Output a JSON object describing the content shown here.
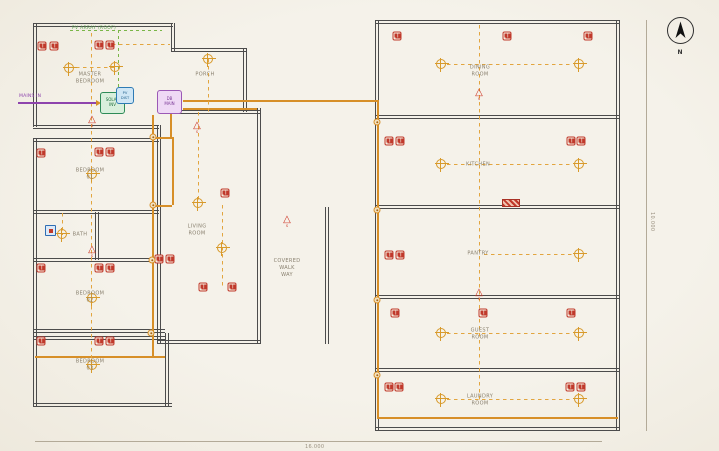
{
  "drawing": {
    "north_label": "N",
    "dimensions": {
      "bottom": "16.000",
      "right": "10.000"
    },
    "annotations": {
      "pv_array": "PV ARRAY (ROOF)",
      "mains": "MAINS IN",
      "switch_label": "S"
    },
    "equipment": {
      "solar_inverter": {
        "line1": "SOLAR",
        "line2": "INV"
      },
      "pv_dist": {
        "line1": "PV",
        "line2": "DIST"
      },
      "db_main": {
        "line1": "DB",
        "line2": "MAIN"
      }
    },
    "icons": {
      "switch_triangle": "△",
      "north_arrow": "north-arrow",
      "ceiling_light": "circle-cross-light",
      "power_outlet": "duplex-outlet"
    },
    "colors": {
      "background": "#f5f2ea",
      "wall": "#4c4c4c",
      "outlet_red": "#c0392b",
      "light_orange": "#d89a2b",
      "circuit_dashed": "#e2a53f",
      "feeder_solid": "#d78f28",
      "pv_green": "#7ab648",
      "mains_purple": "#8e44ad",
      "solar_box": "#2e8b57",
      "pv_box": "#2e7bb5",
      "db_box": "#9b59b6",
      "label_gray": "#89806f"
    },
    "rooms": [
      {
        "label": "MASTER BEDROOM",
        "x": 90,
        "y": 78
      },
      {
        "label": "PORCH",
        "x": 205,
        "y": 75
      },
      {
        "label": "BEDROOM 01",
        "x": 90,
        "y": 174
      },
      {
        "label": "BATH",
        "x": 80,
        "y": 235
      },
      {
        "label": "BEDROOM 02",
        "x": 90,
        "y": 297
      },
      {
        "label": "BEDROOM 03",
        "x": 90,
        "y": 365
      },
      {
        "label": "LIVING ROOM",
        "x": 197,
        "y": 230
      },
      {
        "label": "COVERED\nWALK WAY",
        "x": 287,
        "y": 268
      },
      {
        "label": "DINING ROOM",
        "x": 480,
        "y": 71
      },
      {
        "label": "KITCHEN",
        "x": 478,
        "y": 165
      },
      {
        "label": "PANTRY",
        "x": 478,
        "y": 254
      },
      {
        "label": "GUEST ROOM",
        "x": 480,
        "y": 334
      },
      {
        "label": "LAUNDRY ROOM",
        "x": 480,
        "y": 400
      }
    ],
    "symbols": {
      "outlets": [
        [
          42,
          46
        ],
        [
          54,
          46
        ],
        [
          99,
          45
        ],
        [
          110,
          45
        ],
        [
          41,
          153
        ],
        [
          99,
          152
        ],
        [
          110,
          152
        ],
        [
          41,
          268
        ],
        [
          99,
          268
        ],
        [
          110,
          268
        ],
        [
          159,
          259
        ],
        [
          170,
          259
        ],
        [
          41,
          341
        ],
        [
          99,
          341
        ],
        [
          110,
          341
        ],
        [
          225,
          193
        ],
        [
          203,
          287
        ],
        [
          232,
          287
        ],
        [
          397,
          36
        ],
        [
          507,
          36
        ],
        [
          588,
          36
        ],
        [
          389,
          141
        ],
        [
          400,
          141
        ],
        [
          571,
          141
        ],
        [
          581,
          141
        ],
        [
          389,
          255
        ],
        [
          400,
          255
        ],
        [
          395,
          313
        ],
        [
          483,
          313
        ],
        [
          571,
          313
        ],
        [
          389,
          387
        ],
        [
          399,
          387
        ],
        [
          570,
          387
        ],
        [
          581,
          387
        ]
      ],
      "lights": [
        [
          69,
          68
        ],
        [
          115,
          67
        ],
        [
          208,
          59
        ],
        [
          92,
          174
        ],
        [
          62,
          234
        ],
        [
          92,
          298
        ],
        [
          92,
          365
        ],
        [
          198,
          203
        ],
        [
          222,
          248
        ],
        [
          441,
          64
        ],
        [
          579,
          64
        ],
        [
          441,
          164
        ],
        [
          579,
          164
        ],
        [
          579,
          254
        ],
        [
          441,
          333
        ],
        [
          579,
          333
        ],
        [
          441,
          399
        ],
        [
          579,
          399
        ]
      ],
      "switches": [
        [
          92,
          122
        ],
        [
          197,
          128
        ],
        [
          92,
          252
        ],
        [
          287,
          222
        ],
        [
          479,
          95
        ],
        [
          479,
          295
        ]
      ],
      "junctions": [
        [
          153,
          137
        ],
        [
          153,
          205
        ],
        [
          152,
          260
        ],
        [
          151,
          333
        ],
        [
          377,
          122
        ],
        [
          377,
          210
        ],
        [
          377,
          300
        ],
        [
          377,
          375
        ]
      ]
    }
  }
}
